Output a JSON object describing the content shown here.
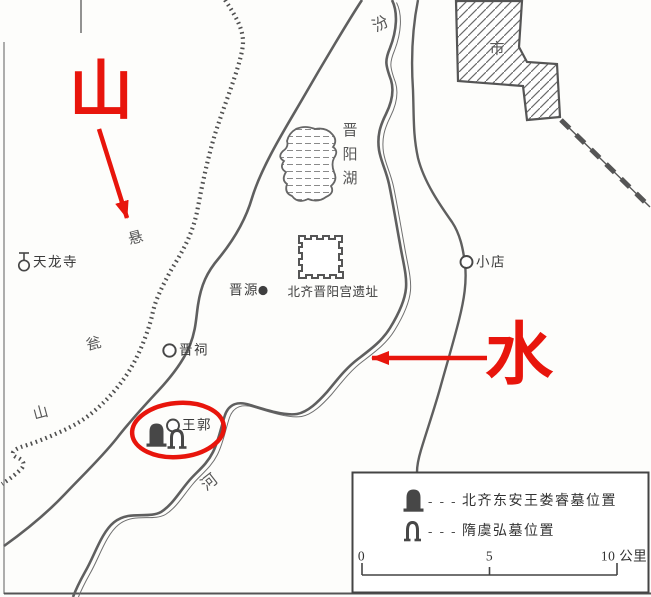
{
  "annotations": {
    "mountain_char": "山",
    "water_char": "水"
  },
  "labels": {
    "fen": "汾",
    "he": "河",
    "city": "市",
    "jinyang_lake": "晋阳湖",
    "xuan": "悬",
    "weng": "瓮",
    "shan_small": "山",
    "tianlong_temple": "天龙寺",
    "jinyuan": "晋源",
    "palace_ruins": "北齐晋阳宫遗址",
    "jinci": "晋祠",
    "wangguo": "王郭",
    "xiaodian": "小店"
  },
  "legend": {
    "items": [
      {
        "dashes": "- - -",
        "label": "北齐东安王娄睿墓位置"
      },
      {
        "dashes": "- - -",
        "label": "隋虞弘墓位置"
      }
    ],
    "scale": {
      "tick0": "0",
      "tick5": "5",
      "tick10": "10 公里"
    }
  },
  "colors": {
    "annotation_red": "#e8150c",
    "line_gray": "#5f5f5f",
    "text_dark": "#3b3b3b"
  }
}
